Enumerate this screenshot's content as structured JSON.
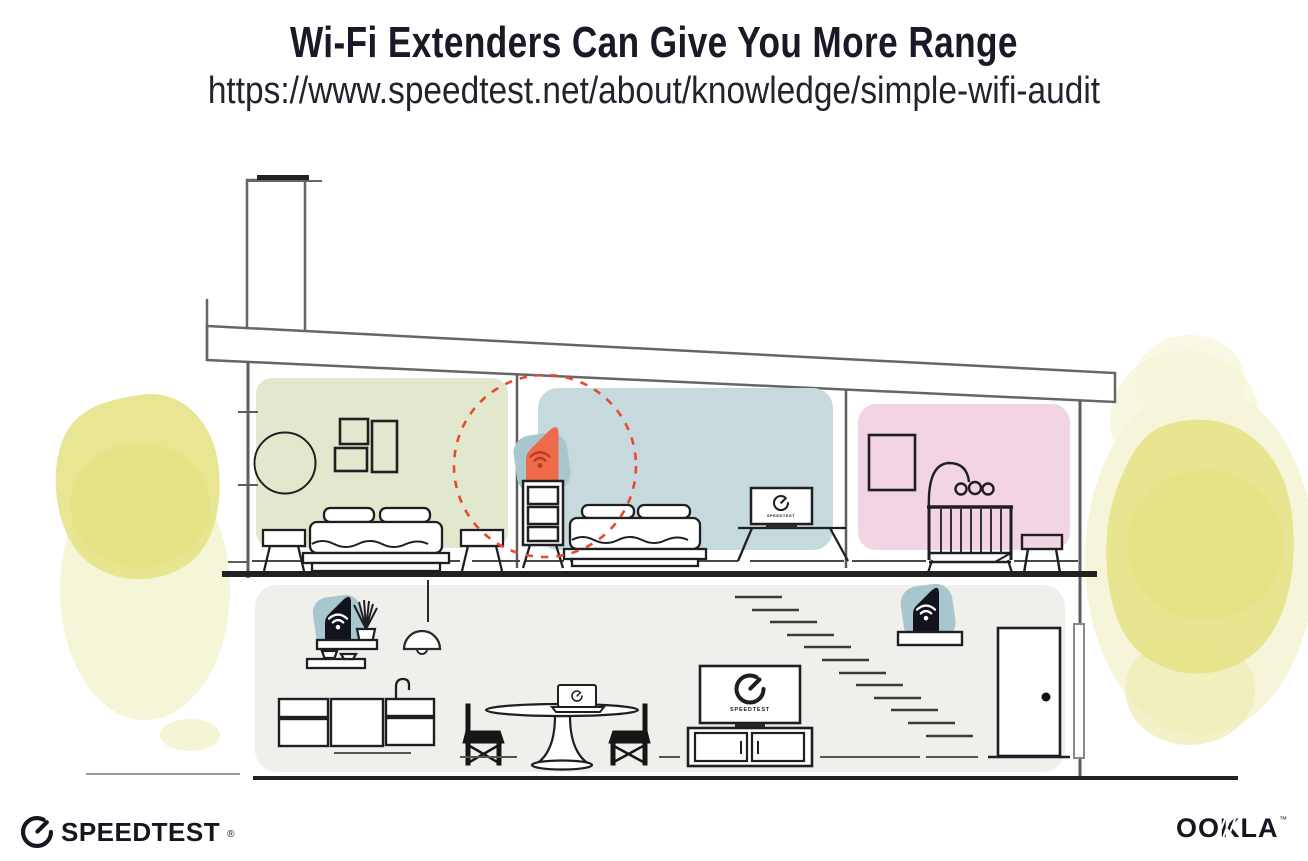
{
  "header": {
    "title": "Wi-Fi Extenders Can Give You More Range",
    "url": "https://www.speedtest.net/about/knowledge/simple-wifi-audit"
  },
  "diagram": {
    "tv_upstairs_label": "SPEEDTEST",
    "tv_living_label": "SPEEDTEST",
    "rooms": [
      {
        "name": "upstairs-bedroom-left",
        "color": "#e1e8cd"
      },
      {
        "name": "upstairs-bedroom-middle",
        "color": "#c6d9dd"
      },
      {
        "name": "upstairs-nursery",
        "color": "#f3d4e5"
      },
      {
        "name": "downstairs-living-area",
        "color": "#f0efeb"
      }
    ],
    "devices": [
      {
        "name": "wifi-extender-on-dresser",
        "color": "#ef6a4b"
      },
      {
        "name": "router-on-kitchen-shelf",
        "color": "#12131d"
      },
      {
        "name": "router-on-stair-shelf",
        "color": "#12131d"
      }
    ],
    "range_circle_color": "#e64b2e",
    "device_halo_color": "#a8c6ce",
    "foliage_color": "#e6e38a"
  },
  "footer": {
    "speedtest": {
      "label": "SPEEDTEST",
      "mark": "®"
    },
    "ookla": {
      "label": "OOKLA",
      "mark": "™"
    }
  }
}
